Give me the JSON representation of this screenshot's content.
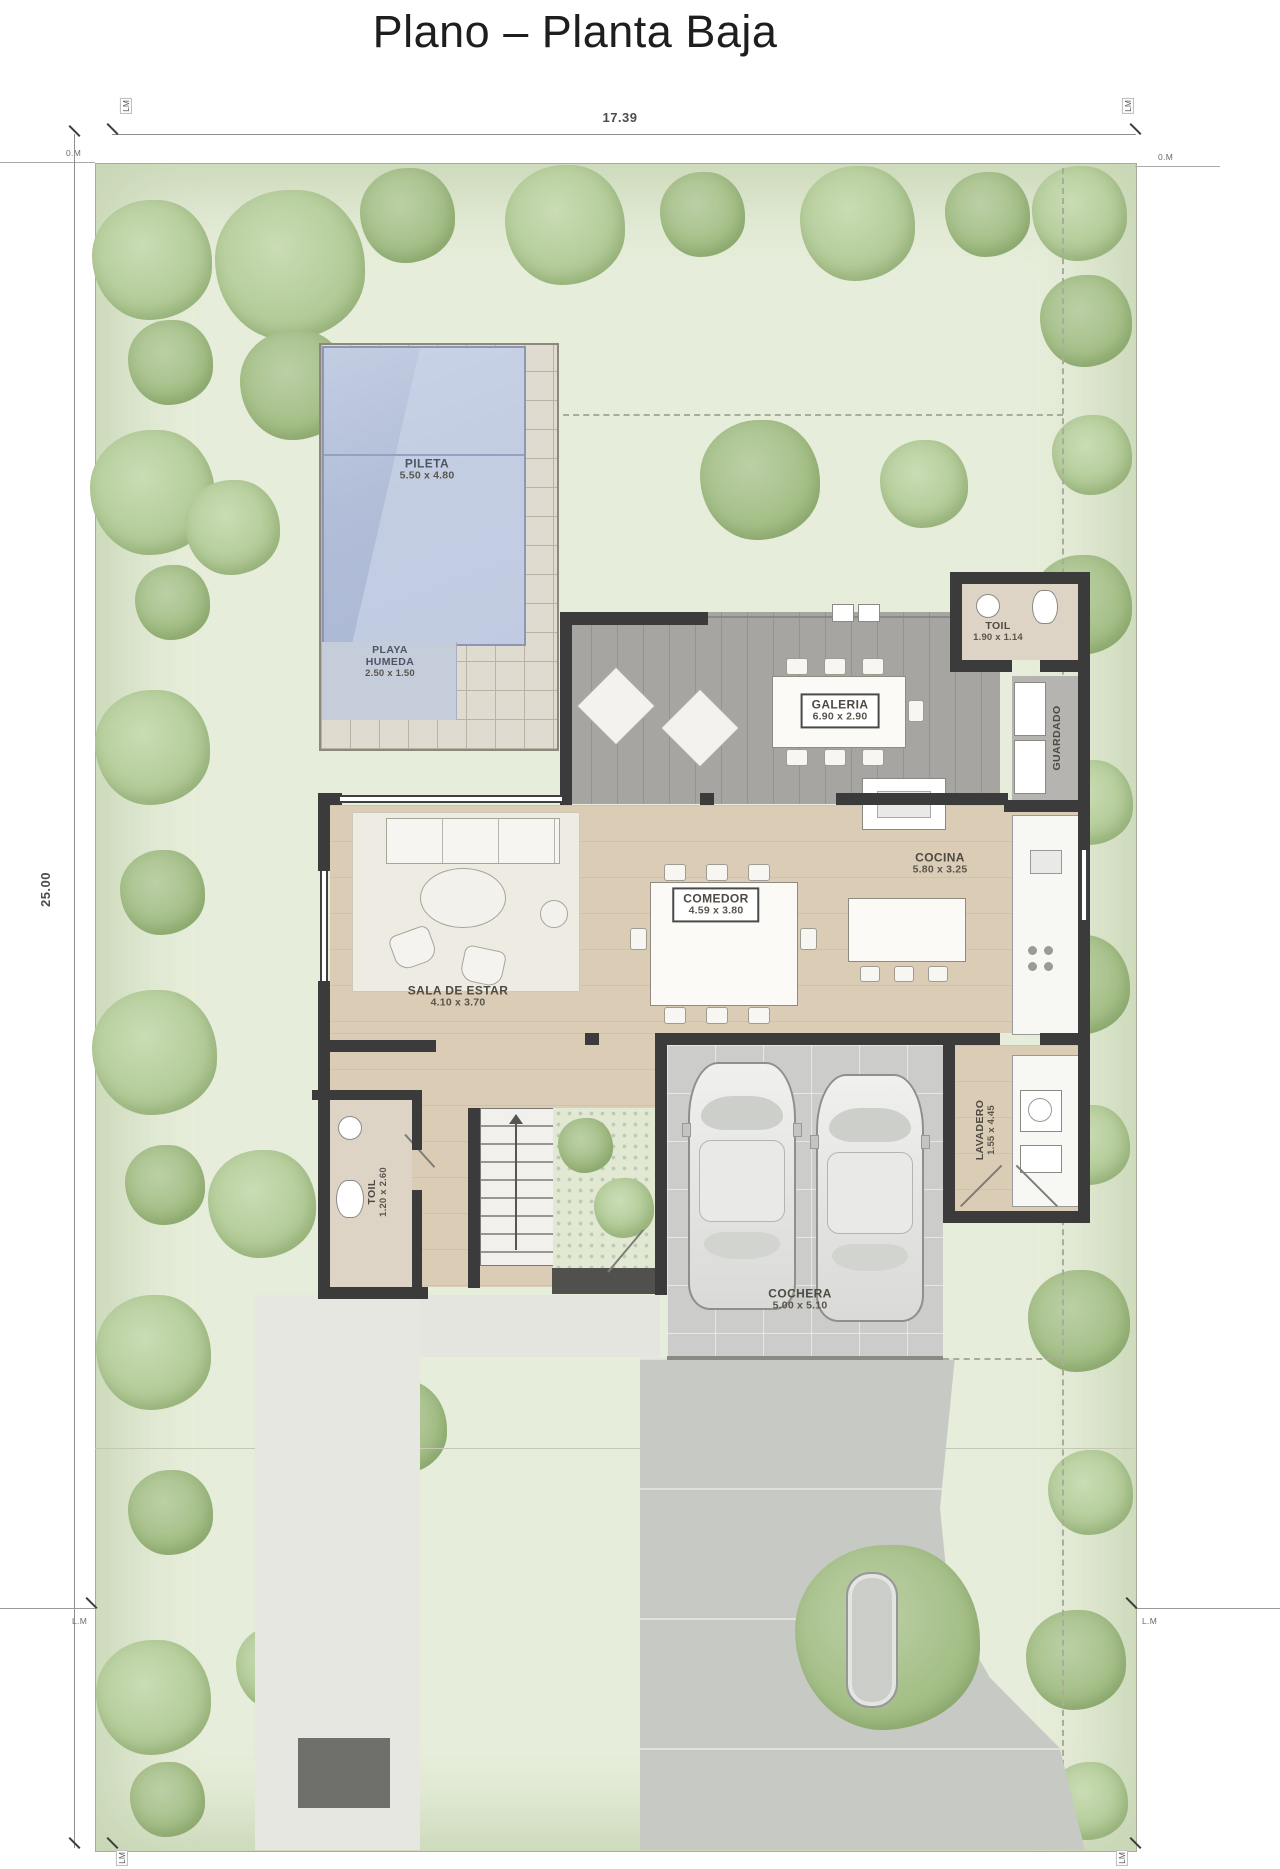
{
  "title": "Plano – Planta Baja",
  "dimensions": {
    "width": "17.39",
    "height": "25.00"
  },
  "markers": {
    "lm": "LM",
    "zero_m": "0.M",
    "l_m": "L.M"
  },
  "rooms": {
    "pileta": {
      "name": "PILETA",
      "size": "5.50 x 4.80"
    },
    "playa_humeda": {
      "name": "PLAYA HUMEDA",
      "size": "2.50 x 1.50"
    },
    "galeria": {
      "name": "GALERIA",
      "size": "6.90 x 2.90"
    },
    "toil_top": {
      "name": "TOIL",
      "size": "1.90 x 1.14"
    },
    "guardado": {
      "name": "GUARDADO"
    },
    "cocina": {
      "name": "COCINA",
      "size": "5.80 x 3.25"
    },
    "comedor": {
      "name": "COMEDOR",
      "size": "4.59 x 3.80"
    },
    "sala_de_estar": {
      "name": "SALA DE ESTAR",
      "size": "4.10 x 3.70"
    },
    "lavadero": {
      "name": "LAVADERO",
      "size": "1.55 x 4.45"
    },
    "toil_bottom": {
      "name": "TOIL",
      "size": "1.20 x 2.60"
    },
    "cochera": {
      "name": "COCHERA",
      "size": "5.00 x 5.10"
    }
  },
  "colors": {
    "pool_water": "#b3bfd9",
    "deck_tile": "#e0dbd0",
    "galeria_deck": "#a6a5a2",
    "wood_floor": "#dbccb5",
    "wall": "#3b3b3b",
    "lot_green": "#e6edda",
    "tree_green": "#b4cc99",
    "garage_floor": "#ccccca",
    "driveway": "#c7c9c4",
    "label_text": "#4e4a42"
  }
}
